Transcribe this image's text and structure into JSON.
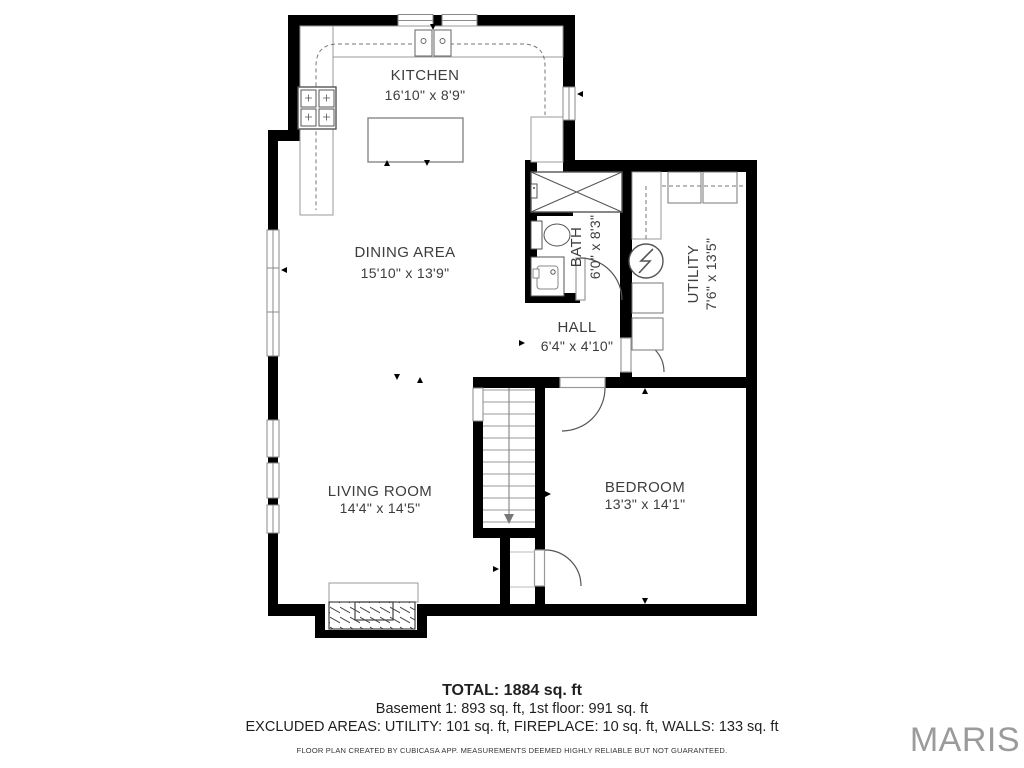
{
  "plan": {
    "rooms": [
      {
        "name": "KITCHEN",
        "dims": "16'10\" x 8'9\""
      },
      {
        "name": "DINING AREA",
        "dims": "15'10\" x 13'9\""
      },
      {
        "name": "BATH",
        "dims": "6'0\" x 8'3\""
      },
      {
        "name": "UTILITY",
        "dims": "7'6\" x 13'5\""
      },
      {
        "name": "HALL",
        "dims": "6'4\" x 4'10\""
      },
      {
        "name": "LIVING ROOM",
        "dims": "14'4\" x 14'5\""
      },
      {
        "name": "BEDROOM",
        "dims": "13'3\" x 14'1\""
      }
    ]
  },
  "summary": {
    "total": "TOTAL: 1884 sq. ft",
    "floors": "Basement 1: 893 sq. ft, 1st floor: 991 sq. ft",
    "excluded": "EXCLUDED AREAS: UTILITY: 101 sq. ft, FIREPLACE: 10 sq. ft, WALLS: 133 sq. ft",
    "disclaimer": "FLOOR PLAN CREATED BY CUBICASA APP. MEASUREMENTS DEEMED HIGHLY RELIABLE BUT NOT GUARANTEED."
  },
  "branding": {
    "logo_text": "MARIS",
    "logo_color": "#9b9b9b"
  },
  "colors": {
    "wall": "#000000",
    "fixture_outline": "#8a8a8a",
    "label_text": "#3d3d3d"
  }
}
